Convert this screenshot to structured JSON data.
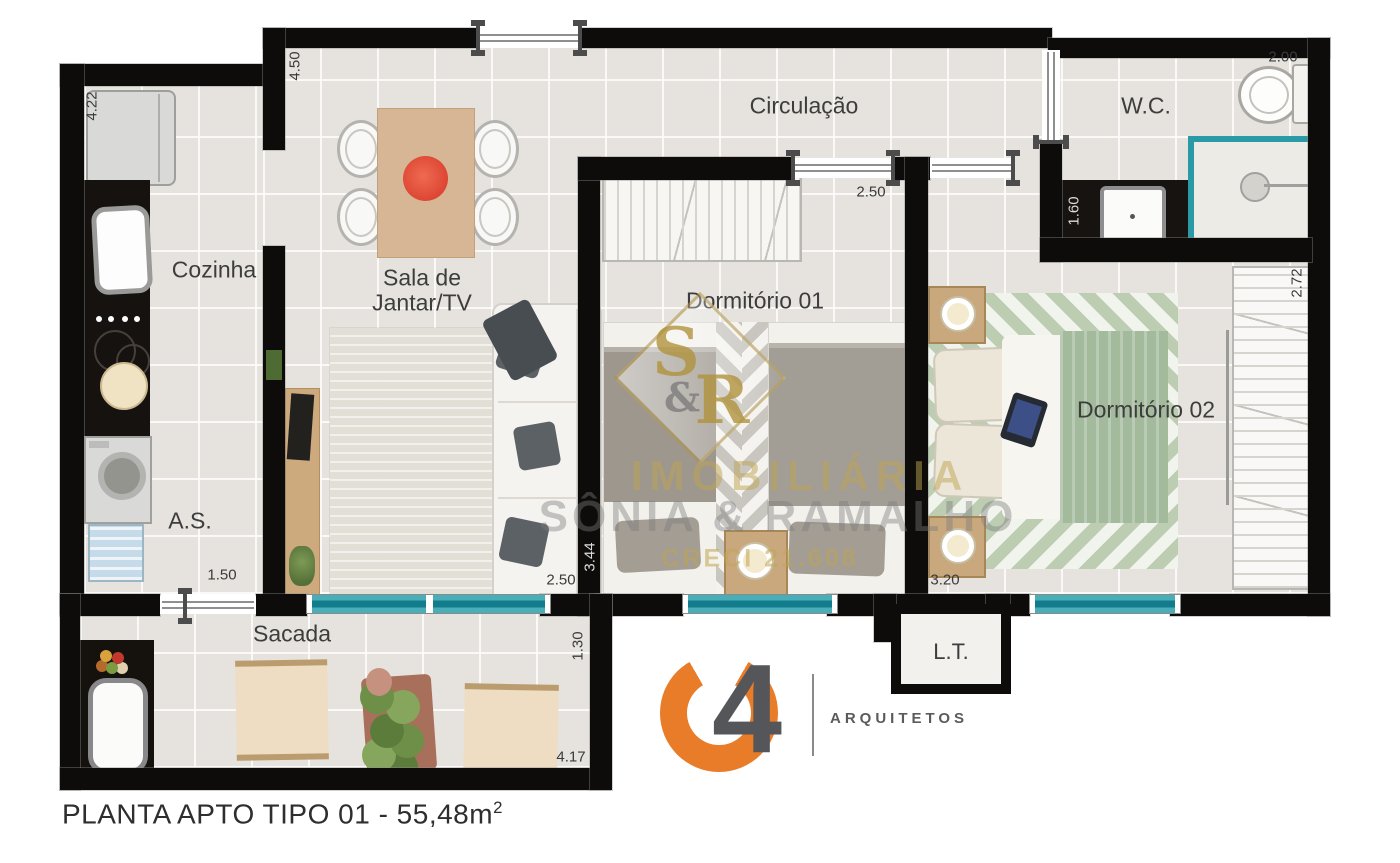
{
  "title": {
    "main": "PLANTA APTO TIPO 01 - 55,48m",
    "sup": "2"
  },
  "rooms": {
    "cozinha": "Cozinha",
    "sala_line1": "Sala de",
    "sala_line2": "Jantar/TV",
    "circulacao": "Circulação",
    "wc": "W.C.",
    "dormitorio1": "Dormitório 01",
    "dormitorio2": "Dormitório 02",
    "as": "A.S.",
    "sacada": "Sacada",
    "lt": "L.T."
  },
  "dimensions": {
    "cozinha_depth": "4.22",
    "sala_depth": "4.50",
    "circulacao_door": "2.50",
    "wc_width": "2.00",
    "wc_vanity": "1.60",
    "dorm2_depth": "2.72",
    "dorm1_depth": "3.44",
    "sala_width": "2.50",
    "dorm2_width": "3.20",
    "as_door": "1.50",
    "sacada_depth": "1.30",
    "sacada_width": "4.17"
  },
  "watermark": {
    "monogram_s": "S",
    "monogram_amp": "&",
    "monogram_r": "R",
    "line1": "IMOBILIÁRIA",
    "line2": "SÔNIA & RAMALHO",
    "line3": "CRECI 21.608"
  },
  "logo": {
    "number": "4",
    "subtitle": "ARQUITETOS"
  },
  "colors": {
    "wall": "#0d0c0a",
    "teal": "#2a9aa7",
    "centerpiece_red": "#e14b3b",
    "logo_orange": "#e87c28",
    "watermark_gold": "#c0a450"
  }
}
